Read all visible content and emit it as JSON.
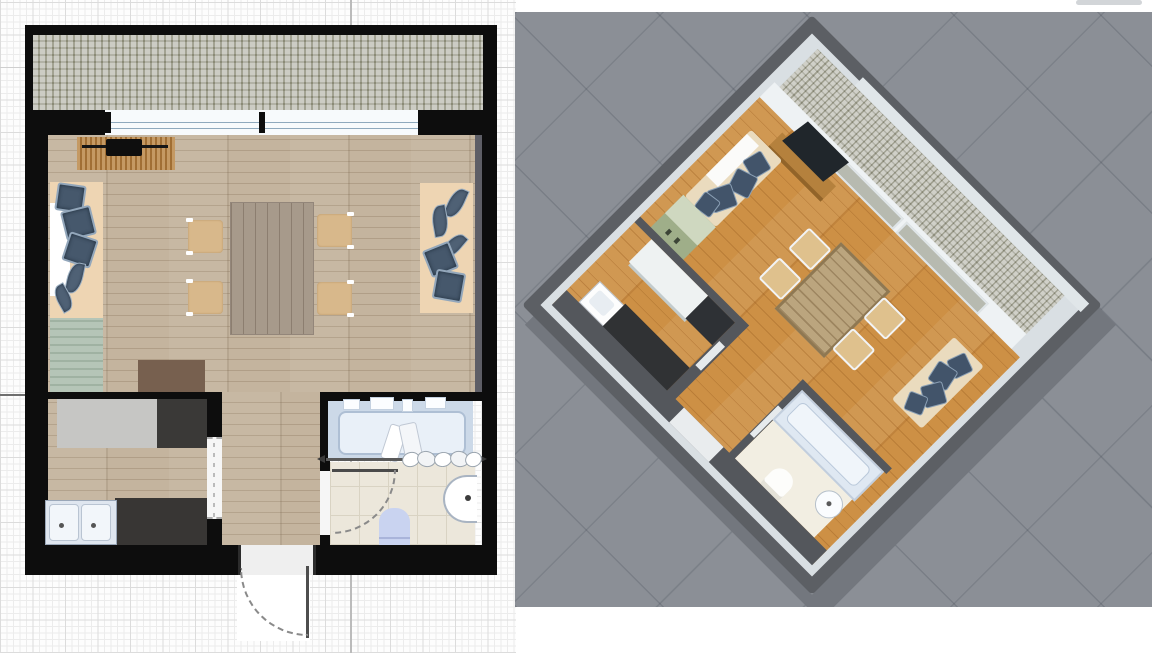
{
  "views": {
    "plan_2d": {
      "label": "2D floor plan view",
      "rooms": {
        "balcony": {
          "label": "Balcony",
          "floor": "cobblestone",
          "floor_color": "#a3a396"
        },
        "living_room": {
          "label": "Living room",
          "floor": "light wood",
          "floor_color": "#c4b49e"
        },
        "kitchen": {
          "label": "Kitchen",
          "floor": "light wood",
          "floor_color": "#c4b49e"
        },
        "bathroom": {
          "label": "Bathroom",
          "floor": "cream tile",
          "floor_color": "#ece7db"
        },
        "entry": {
          "label": "Entry hall",
          "floor": "light wood",
          "floor_color": "#c4b49e"
        }
      },
      "furniture": {
        "tv_stand": {
          "label": "TV stand with TV and soundbar",
          "color": "#b07c3e"
        },
        "sofa_left": {
          "label": "Sofa with white throw and blue cushions",
          "color": "#eed5b3"
        },
        "sideboard": {
          "label": "Green sideboard",
          "color": "#a9bcab"
        },
        "coffee_table": {
          "label": "Coffee table",
          "color": "#77604f"
        },
        "dining_table": {
          "label": "Dining table",
          "color": "#a79a8b"
        },
        "dining_chair": {
          "label": "Dining chair",
          "count": 4,
          "color": "#d8b88b"
        },
        "sofa_right": {
          "label": "Sofa with blue cushions",
          "color": "#eed5b3"
        },
        "counter": {
          "label": "Kitchen counter",
          "color": "#c6c6c4"
        },
        "cooktop": {
          "label": "Dark counter / cooktop",
          "color": "#3a3937"
        },
        "sink": {
          "label": "Double-basin kitchen sink",
          "color": "#e9eef5"
        },
        "counter_dark": {
          "label": "Dark kitchen worktop",
          "color": "#383634"
        },
        "bathtub": {
          "label": "Bathtub with towels and rail",
          "color": "#dce6f2"
        },
        "washbasin": {
          "label": "Half-round washbasin",
          "color": "#ffffff"
        },
        "toilet": {
          "label": "Toilet",
          "color": "#c9d3f0"
        }
      },
      "openings": {
        "window_top": {
          "label": "Window wall to balcony"
        },
        "entry_door": {
          "label": "Entry door with swing arc"
        },
        "kitchen_door": {
          "label": "Kitchen doorway"
        },
        "bathroom_door": {
          "label": "Bathroom door with swing arc"
        }
      },
      "grid": {
        "minor_px": 6.5,
        "major_px": 32.5,
        "major_line_color": "#bbbbbb"
      }
    },
    "view_3d": {
      "label": "3D top-down perspective view",
      "background_color": "#8b8f96",
      "rotation_deg": 45,
      "wall_color": "#5c5f64",
      "floor_color": "#cd9045",
      "contents": [
        "sofa with blue cushions",
        "wall TV on wooden stand",
        "dining table with four chairs",
        "kitchen counters, cooktop and sink",
        "green sideboard",
        "bathroom with bathtub, washbasin and toilet",
        "balcony with stone floor behind window wall"
      ]
    }
  },
  "palette": {
    "wall_black": "#0d0d0d",
    "paper": "#fdfdfd",
    "grid_minor": "#ececec",
    "grid_major": "#dcdcdc",
    "shadow_3d": "#73777e"
  }
}
